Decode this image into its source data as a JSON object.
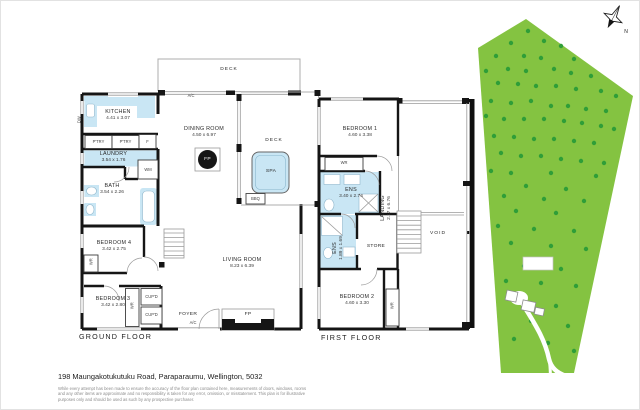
{
  "colors": {
    "wall": "#151515",
    "fixture_blue": "#c9e6f4",
    "land_green": "#84c341",
    "tree_green": "#2f9e38"
  },
  "ground_floor": {
    "title": "GROUND FLOOR",
    "deck_top": "DECK",
    "ac_top": "A/C",
    "kitchen_name": "KITCHEN",
    "kitchen_dims": "4.41 x 3.07",
    "dw": "DW",
    "pantry1": "P'TRY",
    "pantry2": "P'TRY",
    "fridge": "F",
    "laundry_name": "LAUNDRY",
    "laundry_dims": "3.54 x 1.76",
    "wm": "WM",
    "bath_name": "BATH",
    "bath_dims": "3.54 x 2.26",
    "dining_name": "DINING ROOM",
    "dining_dims": "4.50 x 6.97",
    "fp_dining": "FP",
    "deck_right": "DECK",
    "spa": "SPA",
    "bbq": "BBQ",
    "bed4_name": "BEDROOM 4",
    "bed4_dims": "3.42 x 2.75",
    "wr_bed4": "WR",
    "bed3_name": "BEDROOM 3",
    "bed3_dims": "3.42 x 2.80",
    "wr_bed3": "WR",
    "cupd1": "CUP'D",
    "cupd2": "CUP'D",
    "foyer": "FOYER",
    "ac_entry": "A/C",
    "living_name": "LIVING ROOM",
    "living_dims": "8.23 x 6.39",
    "fp_living": "FP"
  },
  "first_floor": {
    "title": "FIRST FLOOR",
    "bed1_name": "BEDROOM 1",
    "bed1_dims": "4.60 x 3.38",
    "wr_bed1": "WR",
    "ens1_name": "ENS",
    "ens1_dims": "3.40 x 2.74",
    "landing_name": "LANDING",
    "landing_dims": "2.17 x 6.76",
    "ens2_name": "ENS",
    "ens2_dims": "1.89 x 1.69",
    "store": "STORE",
    "void": "VOID",
    "bed2_name": "BEDROOM 2",
    "bed2_dims": "4.60 x 3.30",
    "wr_bed2": "WR"
  },
  "compass": {
    "north": "N"
  },
  "footer": {
    "address": "198 Maungakotukutuku Road, Paraparaumu, Wellington, 5032",
    "disclaimer": "While every attempt has been made to ensure the accuracy of the floor plan contained here, measurements of doors, windows, rooms and any other items are approximate and no responsibility is taken for any error, omission, or misstatement. This plan is for illustrative purposes only and should be used as such by any prospective purchaser."
  },
  "site_plan": {
    "colors": {
      "land": "#84c341",
      "tree": "#2f9e38"
    },
    "trees": [
      [
        72,
        30
      ],
      [
        55,
        42
      ],
      [
        88,
        40
      ],
      [
        105,
        45
      ],
      [
        40,
        55
      ],
      [
        68,
        55
      ],
      [
        85,
        57
      ],
      [
        118,
        58
      ],
      [
        30,
        70
      ],
      [
        52,
        68
      ],
      [
        70,
        70
      ],
      [
        98,
        68
      ],
      [
        115,
        72
      ],
      [
        135,
        75
      ],
      [
        42,
        82
      ],
      [
        62,
        83
      ],
      [
        80,
        85
      ],
      [
        100,
        85
      ],
      [
        120,
        88
      ],
      [
        145,
        90
      ],
      [
        160,
        95
      ],
      [
        35,
        100
      ],
      [
        55,
        102
      ],
      [
        75,
        100
      ],
      [
        95,
        105
      ],
      [
        112,
        105
      ],
      [
        130,
        108
      ],
      [
        150,
        110
      ],
      [
        30,
        115
      ],
      [
        48,
        118
      ],
      [
        68,
        118
      ],
      [
        88,
        118
      ],
      [
        108,
        120
      ],
      [
        126,
        122
      ],
      [
        145,
        125
      ],
      [
        158,
        128
      ],
      [
        38,
        135
      ],
      [
        58,
        136
      ],
      [
        78,
        138
      ],
      [
        98,
        138
      ],
      [
        118,
        140
      ],
      [
        138,
        142
      ],
      [
        45,
        152
      ],
      [
        65,
        155
      ],
      [
        85,
        155
      ],
      [
        105,
        158
      ],
      [
        125,
        160
      ],
      [
        148,
        162
      ],
      [
        35,
        170
      ],
      [
        55,
        172
      ],
      [
        95,
        172
      ],
      [
        140,
        175
      ],
      [
        70,
        185
      ],
      [
        110,
        188
      ],
      [
        48,
        195
      ],
      [
        88,
        198
      ],
      [
        128,
        200
      ],
      [
        60,
        210
      ],
      [
        100,
        212
      ],
      [
        42,
        225
      ],
      [
        78,
        228
      ],
      [
        118,
        230
      ],
      [
        55,
        242
      ],
      [
        95,
        245
      ],
      [
        130,
        248
      ],
      [
        68,
        265
      ],
      [
        105,
        268
      ],
      [
        50,
        280
      ],
      [
        85,
        282
      ],
      [
        120,
        285
      ],
      [
        62,
        300
      ],
      [
        100,
        305
      ],
      [
        75,
        320
      ],
      [
        112,
        325
      ],
      [
        58,
        338
      ],
      [
        92,
        342
      ],
      [
        118,
        350
      ]
    ]
  }
}
